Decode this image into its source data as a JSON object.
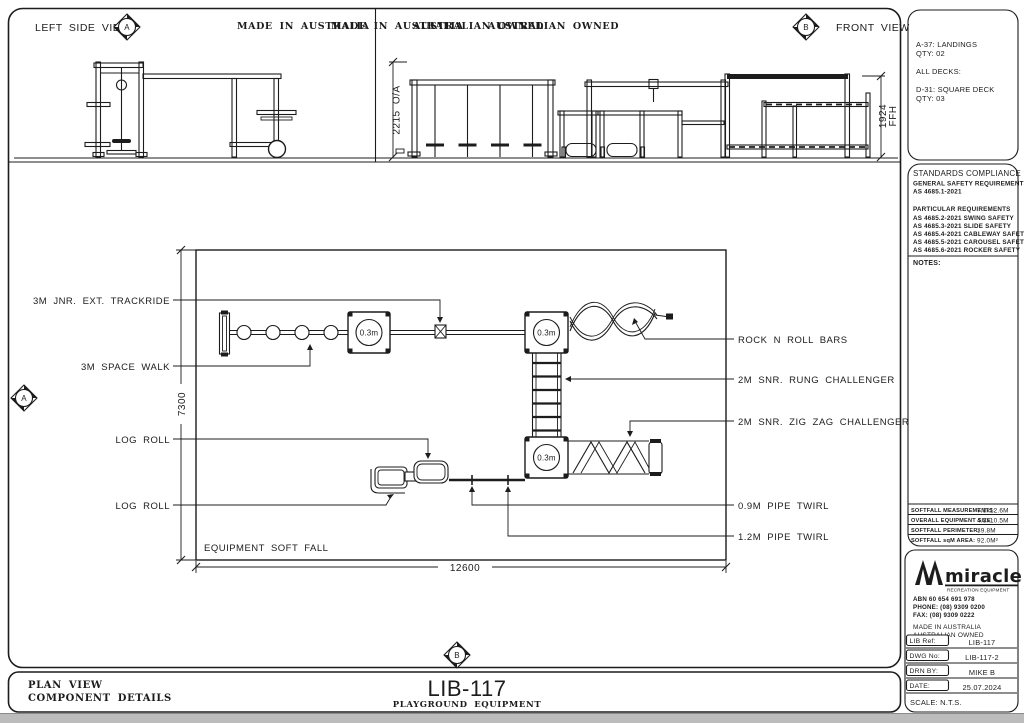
{
  "colors": {
    "ink": "#1c1c1c",
    "taskbar": "#bcbcbc"
  },
  "header": {
    "left_view": "LEFT SIDE VIEW",
    "front_view": "FRONT VIEW",
    "made_in": "MADE IN AUSTRALIA",
    "owned": "AUSTRALIAN OWNED",
    "marker_a": "A",
    "marker_b": "B"
  },
  "dims": {
    "overall_height": "2215 O/A",
    "ffh_value": "1924",
    "ffh_unit": "FFH",
    "plan_depth": "7300",
    "plan_width": "12600"
  },
  "plan": {
    "deck_label": "0.3m",
    "softfall": "EQUIPMENT SOFT FALL",
    "labels_left": [
      "3M JNR. EXT. TRACKRIDE",
      "3M SPACE WALK",
      "LOG ROLL",
      "LOG ROLL"
    ],
    "labels_right": [
      "ROCK N ROLL BARS",
      "2M SNR. RUNG CHALLENGER",
      "2M SNR. ZIG ZAG CHALLENGER",
      "0.9M PIPE TWIRL",
      "1.2M PIPE TWIRL"
    ]
  },
  "components_box": {
    "lines": [
      "A-37: LANDINGS",
      "QTY: 02",
      "ALL DECKS:",
      "D-31: SQUARE DECK",
      "QTY: 03"
    ]
  },
  "standards_box": {
    "title": "STANDARDS COMPLIANCE",
    "general_heading": "GENERAL SAFETY REQUIREMENTS",
    "general_code": "AS 4685.1-2021",
    "particular_heading": "PARTICULAR REQUIREMENTS",
    "codes": [
      "AS 4685.2-2021 SWING SAFETY",
      "AS 4685.3-2021 SLIDE SAFETY",
      "AS 4685.4-2021 CABLEWAY SAFETY",
      "AS 4685.5-2021 CAROUSEL SAFETY",
      "AS 4685.6-2021 ROCKER SAFETY"
    ],
    "notes": "NOTES:"
  },
  "softfall_table": {
    "rows": [
      {
        "label": "SOFTFALL MEASUREMENTS:",
        "value": "7.3x12.6M"
      },
      {
        "label": "OVERALL EQUIPMENT SIZE:",
        "value": "4.5x10.5M"
      },
      {
        "label": "SOFTFALL PERIMETER:",
        "value": "39.8M"
      },
      {
        "label": "SOFTFALL sqM AREA:",
        "value": "92.0M²"
      }
    ]
  },
  "company": {
    "name": "miracle",
    "tagline": "RECREATION EQUIPMENT",
    "abn": "ABN 60 654 691 978",
    "phone": "PHONE: (08) 9309 0200",
    "fax": "FAX:   (08) 9309 0222",
    "made_in": "MADE IN AUSTRALIA",
    "owned": "AUSTRALIAN OWNED"
  },
  "title_block": {
    "rows": [
      {
        "label": "LIB Ref:",
        "value": "LIB-117"
      },
      {
        "label": "DWG No:",
        "value": "LIB-117-2"
      },
      {
        "label": "DRN BY:",
        "value": "MIKE B"
      },
      {
        "label": "DATE:",
        "value": "25.07.2024"
      }
    ],
    "scale": "SCALE: N.T.S."
  },
  "footer": {
    "view": "PLAN VIEW",
    "details": "COMPONENT DETAILS",
    "code": "LIB-117",
    "subtitle": "PLAYGROUND EQUIPMENT"
  }
}
